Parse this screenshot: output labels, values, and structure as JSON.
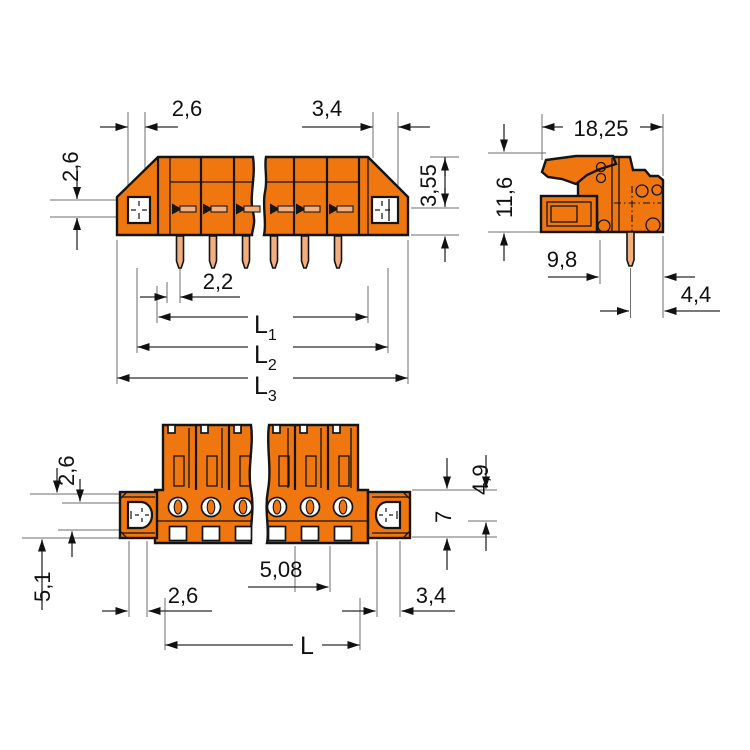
{
  "views": {
    "front": {
      "dims": {
        "flange_width_left": "2,6",
        "flange_width_right": "3,4",
        "upper_height": "2,6",
        "right_height": "3,55",
        "pin_offset": "2,2",
        "l1": {
          "base": "L",
          "sub": "1"
        },
        "l2": {
          "base": "L",
          "sub": "2"
        },
        "l3": {
          "base": "L",
          "sub": "3"
        }
      }
    },
    "side": {
      "dims": {
        "depth": "18,25",
        "height": "11,6",
        "flange_depth": "9,8",
        "pin_to_edge": "4,4"
      }
    },
    "bottom": {
      "dims": {
        "upper_height": "2,6",
        "lower_drop": "5,1",
        "upper_half": "4,9",
        "flange_height": "7",
        "pitch": "5,08",
        "hole_width_left": "2,6",
        "hole_width_right": "3,4",
        "length": "L"
      }
    }
  },
  "colors": {
    "housing": "#F0770F",
    "pin": "#F2AE7D",
    "outline": "#141414",
    "dimension": "#2b2b2b",
    "extension": "#6e6e6e",
    "background": "#ffffff"
  }
}
